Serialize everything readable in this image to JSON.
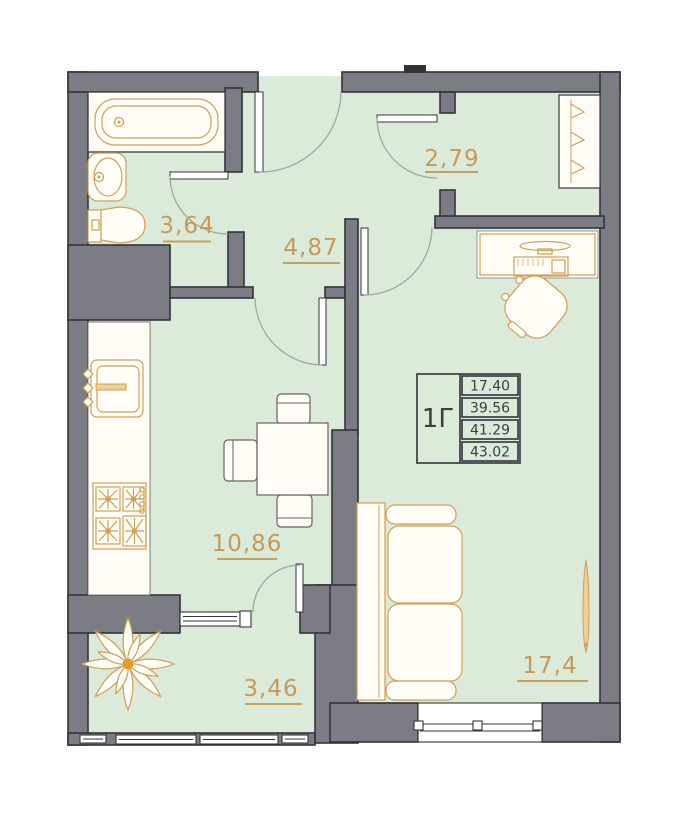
{
  "plan": {
    "unit_table": {
      "type_label": "1Г",
      "values": [
        "17.40",
        "39.56",
        "41.29",
        "43.02"
      ]
    },
    "rooms": {
      "bathroom": {
        "area": "3,64"
      },
      "hallway": {
        "area": "4,87"
      },
      "dressing": {
        "area": "2,79"
      },
      "kitchen_dining": {
        "area": "10,86"
      },
      "balcony": {
        "area": "3,46"
      },
      "living": {
        "area": "17,4"
      }
    },
    "colors": {
      "room_fill": "#dcead9",
      "wall_fill": "#7c7c84",
      "wall_outline": "#33343a",
      "label_accent": "#c49a5c",
      "fixture_line": "#cf9f5c",
      "table_line": "#3c3d43"
    }
  }
}
